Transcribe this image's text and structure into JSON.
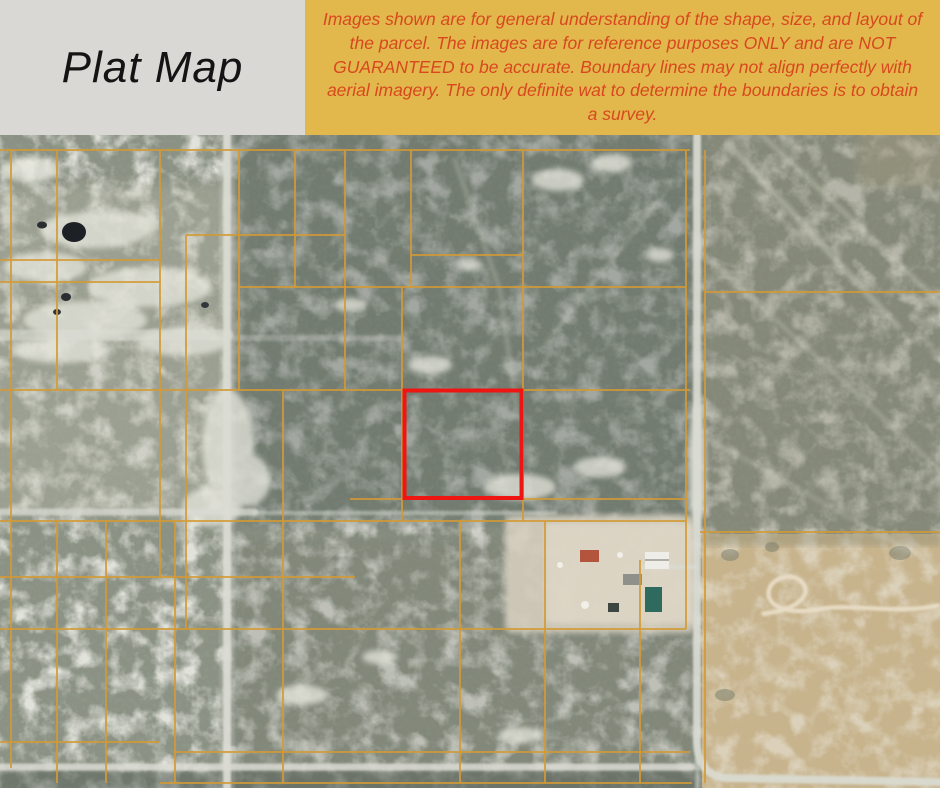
{
  "header": {
    "title": "Plat Map",
    "disclaimer": "Images shown are for general understanding of the shape, size, and layout of the parcel. The images are for reference purposes ONLY and are NOT GUARANTEED to be accurate. Boundary lines may not align perfectly with aerial imagery. The only definite wat to determine the boundaries is to obtain a survey.",
    "colors": {
      "title_panel_bg": "#d9d8d5",
      "title_text": "#141414",
      "disclaimer_panel_bg": "#e2b84c",
      "disclaimer_text": "#d8481f"
    }
  },
  "map": {
    "type": "aerial-plat-map",
    "colors": {
      "parcel_lines": "#d49a35",
      "highlighted_parcel": "#ee1512",
      "roads": "#dadbd3",
      "trail_streaks": "#d9d9cc",
      "loop_road": "#eadfc9"
    }
  }
}
